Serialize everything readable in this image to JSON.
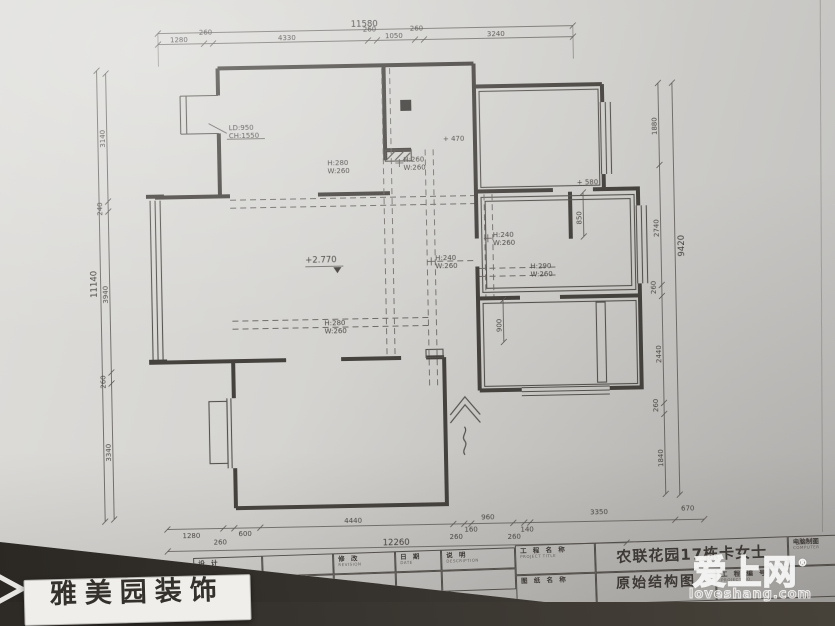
{
  "photo": {
    "sign_text": "雅美园装饰",
    "watermark": {
      "name": "爱上网",
      "reg": "®",
      "domain": "loveshang.com"
    }
  },
  "plan": {
    "level": "+2.770",
    "spot_470": "+ 470",
    "spot_580": "+ 580",
    "lintel_l1": "LD:950",
    "lintel_l2": "CH:1550",
    "beams": [
      {
        "h": "H:280",
        "w": "W:260"
      },
      {
        "h": "H:260",
        "w": "W:260"
      },
      {
        "h": "H:240",
        "w": "W:260"
      },
      {
        "h": "H:240",
        "w": "W:260"
      },
      {
        "h": "H:290",
        "w": "W:260"
      },
      {
        "h": "H:280",
        "w": "W:260"
      }
    ],
    "small_dim_850": "850",
    "small_dim_900": "900"
  },
  "dims": {
    "top": {
      "overall": "11580",
      "segments": [
        "1280",
        "260",
        "4330",
        "260",
        "1050",
        "260",
        "3240"
      ]
    },
    "left": {
      "overall": "11140",
      "segments": [
        "3140",
        "240",
        "3940",
        "260",
        "3340"
      ]
    },
    "right": {
      "overall": "9420",
      "segments": [
        "1880",
        "2740",
        "260",
        "2440",
        "260",
        "1840"
      ]
    },
    "bottom": {
      "overall": "12260",
      "segments": [
        "1280",
        "260",
        "600",
        "4440",
        "260",
        "160",
        "960",
        "260",
        "140",
        "3350",
        "670"
      ]
    }
  },
  "titleblock": {
    "design_cn": "设 计",
    "design_en": "DESIGN",
    "drawer_cn": "制 图",
    "drawer_en": "DRAWER",
    "revision_cn": "修 改",
    "revision_en": "REVISION",
    "date_cn": "日 期",
    "date_en": "DATE",
    "desc_cn": "说 明",
    "desc_en": "DESCRIPTION",
    "project_cn": "工 程 名 称",
    "project_en": "PROJECT TITLE",
    "project_value": "农联花园17栋卡女士",
    "drawing_cn": "图 纸 名 称",
    "drawing_value": "原始结构图",
    "projectno_cn": "工 程 编 号",
    "projectno_en": "PROJECT NO.",
    "computer_cn": "电脑制图",
    "computer_en": "COMPUTER"
  }
}
